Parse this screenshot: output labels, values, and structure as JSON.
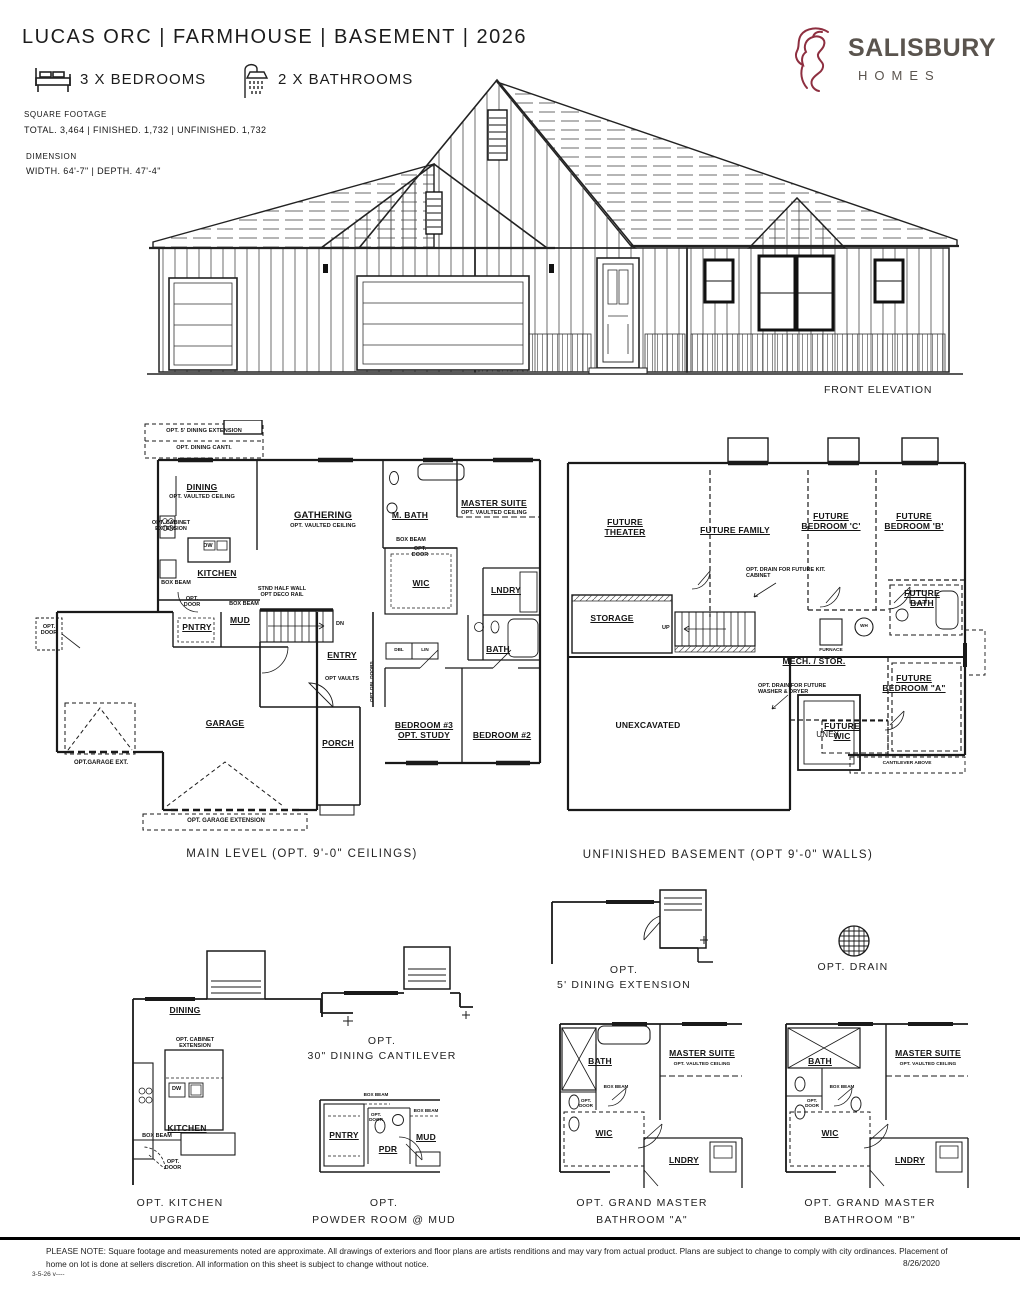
{
  "header": {
    "title": "LUCAS ORC | FARMHOUSE | BASEMENT | 2026",
    "bedrooms": "3 X BEDROOMS",
    "bathrooms": "2 X BATHROOMS",
    "sqft_label": "SQUARE FOOTAGE",
    "sqft_value": "TOTAL. 3,464 | FINISHED. 1,732 | UNFINISHED. 1,732",
    "dim_label": "DIMENSION",
    "dim_value": "WIDTH. 64'-7\" | DEPTH. 47'-4\""
  },
  "logo": {
    "brand": "SALISBURY",
    "sub": "HOMES",
    "lion_color": "#8e2f40",
    "text_color": "#5a544e"
  },
  "elevation": {
    "caption": "FRONT ELEVATION"
  },
  "common": {
    "opt_vaulted": "OPT. VAULTED CEILING",
    "box_beam": "BOX BEAM",
    "opt_door": "OPT. DOOR",
    "dw": "DW"
  },
  "main": {
    "caption": "MAIN LEVEL (OPT. 9'-0\" CEILINGS)",
    "rooms": {
      "dining": "DINING",
      "gathering": "GATHERING",
      "kitchen": "KITCHEN",
      "mbath": "M. BATH",
      "master": "MASTER SUITE",
      "wic": "WIC",
      "lndry": "LNDRY",
      "bath": "BATH",
      "pntry": "PNTRY",
      "mud": "MUD",
      "entry": "ENTRY",
      "porch": "PORCH",
      "garage": "GARAGE",
      "bed3": "BEDROOM #3 OPT. STUDY",
      "bed2": "BEDROOM #2"
    },
    "notes": {
      "dining_ext": "OPT. 5' DINING EXTENSION",
      "dining_cant": "OPT. DINING CANTI.",
      "cab_ext": "OPT. CABINET EXTENSION",
      "half_wall": "STND HALF WALL OPT DECO RAIL",
      "vaults": "OPT VAULTS",
      "dn": "DN",
      "dbl": "DBL",
      "lin": "LIN",
      "gar_ext": "OPT.GARAGE EXT.",
      "gar_extension": "OPT. GARAGE EXTENSION",
      "opt_dbl_doors": "OPT. DBL DOORS"
    }
  },
  "basement": {
    "caption": "UNFINISHED BASEMENT (OPT 9'-0\" WALLS)",
    "rooms": {
      "theater": "FUTURE THEATER",
      "family": "FUTURE FAMILY",
      "bed_c": "FUTURE BEDROOM 'C'",
      "bed_b": "FUTURE BEDROOM 'B'",
      "bed_a": "FUTURE BEDROOM \"A\"",
      "bath": "FUTURE BATH",
      "storage": "STORAGE",
      "mech": "MECH. / STOR.",
      "wic": "FUTURE WIC",
      "unexcavated": "UNEXCAVATED",
      "unex": "UNEX."
    },
    "notes": {
      "up": "UP",
      "wh": "WH",
      "furnace": "FURNACE",
      "drain_kit": "OPT. DRAIN FOR FUTURE KIT. CABINET",
      "drain_wd": "OPT. DRAIN FOR FUTURE WASHER & DRYER",
      "cantilever": "CANTILEVER ABOVE"
    }
  },
  "options": {
    "kitchen_upgrade": {
      "caption1": "OPT. KITCHEN",
      "caption2": "UPGRADE",
      "dining": "DINING",
      "kitchen": "KITCHEN"
    },
    "dining_cantilever": {
      "caption1": "OPT.",
      "caption2": "30\" DINING CANTILEVER"
    },
    "powder": {
      "caption1": "OPT.",
      "caption2": "POWDER ROOM @ MUD",
      "pntry": "PNTRY",
      "pdr": "PDR",
      "mud": "MUD"
    },
    "dining_extension": {
      "caption1": "OPT.",
      "caption2": "5' DINING EXTENSION"
    },
    "drain": {
      "caption": "OPT. DRAIN"
    },
    "gm_a": {
      "caption1": "OPT. GRAND MASTER",
      "caption2": "BATHROOM \"A\"",
      "bath": "BATH",
      "master": "MASTER SUITE",
      "wic": "WIC",
      "lndry": "LNDRY"
    },
    "gm_b": {
      "caption1": "OPT. GRAND MASTER",
      "caption2": "BATHROOM \"B\"",
      "bath": "BATH",
      "master": "MASTER SUITE",
      "wic": "WIC",
      "lndry": "LNDRY"
    }
  },
  "footer": {
    "note": "PLEASE NOTE: Square footage and measurements noted are approximate. All drawings of exteriors and floor plans are artists renditions and may vary from actual product. Plans are subject to change to comply with city ordinances. Placement of home on lot is done at sellers discretion. All information on this sheet is subject to change without notice.",
    "date": "8/26/2020",
    "rev": "3-5-26 v----"
  }
}
